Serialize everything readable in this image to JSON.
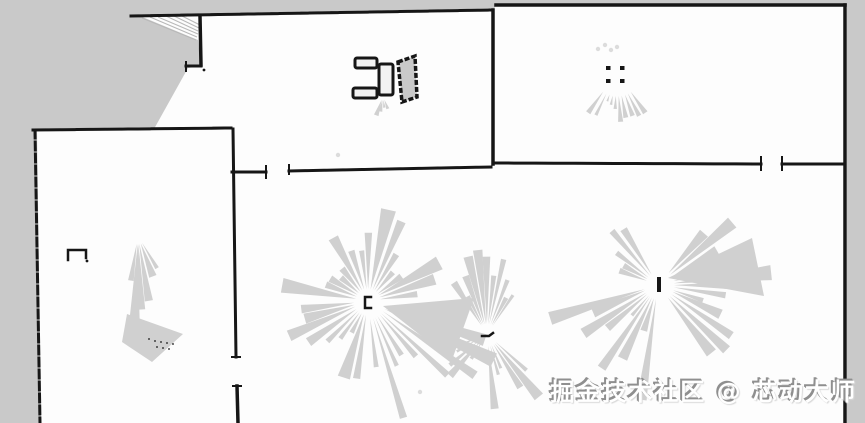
{
  "meta": {
    "width": 865,
    "height": 423,
    "description": "Lidar SLAM occupancy-grid floor map: white explored space, gray unknown space, black walls and obstacles, gray laser-scan shadow fans"
  },
  "watermark": {
    "text": "掘金技术社区 @ 芯动大师"
  },
  "colors": {
    "free": "#fdfdfd",
    "unknown": "#c9c9c9",
    "wall": "#161616",
    "scan": "#d0d0d0",
    "scan_light": "#dcdcdc",
    "hatch": "#b8b8b8"
  },
  "map": {
    "unknown_regions": [
      {
        "name": "unknown-top-band",
        "pts": [
          [
            0,
            0
          ],
          [
            865,
            0
          ],
          [
            865,
            5
          ],
          [
            496,
            5
          ],
          [
            493,
            11
          ],
          [
            131,
            16
          ],
          [
            0,
            16
          ]
        ]
      },
      {
        "name": "unknown-left-block",
        "pts": [
          [
            0,
            16
          ],
          [
            140,
            16
          ],
          [
            198,
            40
          ],
          [
            201,
            66
          ],
          [
            188,
            68
          ],
          [
            154,
            129
          ],
          [
            37,
            130
          ],
          [
            41,
            423
          ],
          [
            0,
            423
          ]
        ]
      },
      {
        "name": "unknown-right-margin",
        "pts": [
          [
            847,
            5
          ],
          [
            865,
            5
          ],
          [
            865,
            423
          ],
          [
            847,
            423
          ]
        ]
      }
    ],
    "hatch_lines": [
      {
        "pts": [
          [
            142,
            18
          ],
          [
            196,
            40
          ]
        ]
      },
      {
        "pts": [
          [
            150,
            17
          ],
          [
            197,
            37
          ]
        ]
      },
      {
        "pts": [
          [
            158,
            17
          ],
          [
            198,
            34
          ]
        ]
      },
      {
        "pts": [
          [
            166,
            16
          ],
          [
            198,
            31
          ]
        ]
      },
      {
        "pts": [
          [
            174,
            16
          ],
          [
            199,
            28
          ]
        ]
      },
      {
        "pts": [
          [
            182,
            16
          ],
          [
            200,
            25
          ]
        ]
      }
    ],
    "walls": [
      {
        "name": "hall-top-wall",
        "pts": [
          [
            131,
            16
          ],
          [
            493,
            10
          ]
        ],
        "w": 3,
        "dash": "7,3"
      },
      {
        "name": "center-divider-wall",
        "pts": [
          [
            493,
            10
          ],
          [
            493,
            164
          ]
        ],
        "w": 3.5
      },
      {
        "name": "top-right-room-top-wall",
        "pts": [
          [
            496,
            5
          ],
          [
            845,
            5
          ]
        ],
        "w": 3.5,
        "dash": "16,2"
      },
      {
        "name": "right-outer-wall",
        "pts": [
          [
            845,
            5
          ],
          [
            845,
            423
          ]
        ],
        "w": 3.5
      },
      {
        "name": "top-right-room-bottom-wall-left",
        "pts": [
          [
            496,
            163
          ],
          [
            761,
            164
          ]
        ],
        "w": 3,
        "dash": "18,2"
      },
      {
        "name": "door-tick-right-room-a",
        "pts": [
          [
            761,
            157
          ],
          [
            761,
            170
          ]
        ],
        "w": 2
      },
      {
        "name": "top-right-room-bottom-wall-right",
        "pts": [
          [
            782,
            164
          ],
          [
            845,
            164
          ]
        ],
        "w": 3
      },
      {
        "name": "door-tick-right-room-b",
        "pts": [
          [
            782,
            157
          ],
          [
            782,
            170
          ]
        ],
        "w": 2
      },
      {
        "name": "corridor-wall-long",
        "pts": [
          [
            289,
            171
          ],
          [
            491,
            167
          ]
        ],
        "w": 3,
        "dash": "16,3"
      },
      {
        "name": "door-tick-corridor-a",
        "pts": [
          [
            289,
            165
          ],
          [
            289,
            174
          ]
        ],
        "w": 2
      },
      {
        "name": "corridor-wall-short",
        "pts": [
          [
            232,
            172
          ],
          [
            266,
            172
          ]
        ],
        "w": 3
      },
      {
        "name": "door-tick-corridor-b",
        "pts": [
          [
            266,
            166
          ],
          [
            266,
            178
          ]
        ],
        "w": 2
      },
      {
        "name": "left-room-top-wall",
        "pts": [
          [
            33,
            130
          ],
          [
            231,
            128
          ]
        ],
        "w": 3,
        "dash": "12,3"
      },
      {
        "name": "left-room-left-wall",
        "pts": [
          [
            35,
            130
          ],
          [
            40,
            423
          ]
        ],
        "w": 3,
        "dash": "8,4"
      },
      {
        "name": "left-divider-wall-upper",
        "pts": [
          [
            233,
            129
          ],
          [
            236,
            357
          ]
        ],
        "w": 3
      },
      {
        "name": "left-divider-wall-lower",
        "pts": [
          [
            237,
            386
          ],
          [
            238,
            423
          ]
        ],
        "w": 3.5
      },
      {
        "name": "door-tick-left-divider-a",
        "pts": [
          [
            232,
            357
          ],
          [
            240,
            357
          ]
        ],
        "w": 2
      },
      {
        "name": "door-tick-left-divider-b",
        "pts": [
          [
            233,
            386
          ],
          [
            241,
            386
          ]
        ],
        "w": 2
      },
      {
        "name": "hall-left-wall",
        "pts": [
          [
            200,
            16
          ],
          [
            201,
            65
          ]
        ],
        "w": 3.5
      },
      {
        "name": "hall-nub-wall",
        "pts": [
          [
            186,
            66
          ],
          [
            201,
            66
          ]
        ],
        "w": 3
      },
      {
        "name": "hall-nub-tick",
        "pts": [
          [
            186,
            62
          ],
          [
            186,
            71
          ]
        ],
        "w": 2
      }
    ],
    "obstacle_rects": [
      {
        "name": "obstacle-box-1",
        "x": 355,
        "y": 58,
        "w": 22,
        "h": 10
      },
      {
        "name": "obstacle-box-2",
        "x": 379,
        "y": 64,
        "w": 14,
        "h": 31
      },
      {
        "name": "obstacle-box-3",
        "x": 353,
        "y": 88,
        "w": 24,
        "h": 10
      }
    ],
    "obstacle_quad": {
      "name": "obstacle-tilted-panel",
      "pts": [
        [
          398,
          62
        ],
        [
          415,
          56
        ],
        [
          417,
          97
        ],
        [
          402,
          102
        ]
      ]
    },
    "table_legs": [
      {
        "x": 606,
        "y": 66
      },
      {
        "x": 620,
        "y": 66
      },
      {
        "x": 606,
        "y": 79
      },
      {
        "x": 620,
        "y": 79
      }
    ],
    "markers": [
      {
        "name": "marker-left-room",
        "d": "M68,260 L68,250 L86,250 L86,258",
        "w": 2.5
      },
      {
        "name": "robot-pose-marker-a",
        "d": "M371,297 L365,297 L365,308 L371,308",
        "w": 2.5
      },
      {
        "name": "scan-dash-marker",
        "d": "M482,336 l7,0 l4,-3",
        "w": 2.5
      }
    ],
    "marker_rects": [
      {
        "name": "robot-pose-marker-b",
        "x": 657,
        "y": 277,
        "w": 4,
        "h": 15
      }
    ],
    "marker_dots": [
      {
        "x": 87,
        "y": 261
      },
      {
        "x": 204,
        "y": 70
      }
    ],
    "hatch_dots": [
      [
        149,
        339
      ],
      [
        155,
        341
      ],
      [
        161,
        342
      ],
      [
        167,
        343
      ],
      [
        173,
        344
      ],
      [
        157,
        347
      ],
      [
        163,
        348
      ],
      [
        169,
        349
      ]
    ],
    "light_specks": [
      [
        598,
        49
      ],
      [
        605,
        45
      ],
      [
        611,
        50
      ],
      [
        617,
        47
      ],
      [
        338,
        155
      ],
      [
        420,
        392
      ]
    ],
    "scan_solids": [
      {
        "name": "scan-shadow-wedge-a",
        "pts": [
          [
            383,
            306
          ],
          [
            474,
            298
          ],
          [
            452,
            360
          ]
        ]
      },
      {
        "name": "scan-shadow-triangle-left-room",
        "pts": [
          [
            127,
            314
          ],
          [
            183,
            334
          ],
          [
            152,
            362
          ],
          [
            122,
            342
          ]
        ]
      },
      {
        "name": "scan-shadow-wedge-c",
        "pts": [
          [
            668,
            278
          ],
          [
            752,
            238
          ],
          [
            764,
            296
          ]
        ]
      }
    ],
    "scan_fans": [
      {
        "name": "scan-fan-a",
        "cx": 368,
        "cy": 301,
        "sectors": [
          {
            "a0": 185,
            "a1": 358,
            "n": 17,
            "r0": 35,
            "r1": 95,
            "inner": 12,
            "wf": 0.4
          },
          {
            "a0": 95,
            "a1": 178,
            "n": 9,
            "r0": 30,
            "r1": 88,
            "inner": 14,
            "wf": 0.38
          },
          {
            "a0": 14,
            "a1": 86,
            "n": 9,
            "r0": 45,
            "r1": 140,
            "inner": 18,
            "wf": 0.3
          }
        ]
      },
      {
        "name": "scan-fan-b",
        "cx": 487,
        "cy": 334,
        "sectors": [
          {
            "a0": 233,
            "a1": 307,
            "n": 11,
            "r0": 40,
            "r1": 103,
            "inner": 10,
            "wf": 0.42
          },
          {
            "a0": 38,
            "a1": 88,
            "n": 6,
            "r0": 30,
            "r1": 85,
            "inner": 12,
            "wf": 0.35
          },
          {
            "a0": 118,
            "a1": 162,
            "n": 5,
            "r0": 25,
            "r1": 65,
            "inner": 10,
            "wf": 0.35
          }
        ]
      },
      {
        "name": "scan-fan-c",
        "cx": 658,
        "cy": 285,
        "sectors": [
          {
            "a0": -52,
            "a1": 55,
            "n": 13,
            "r0": 45,
            "r1": 115,
            "inner": 16,
            "wf": 0.45
          },
          {
            "a0": 95,
            "a1": 168,
            "n": 9,
            "r0": 35,
            "r1": 118,
            "inner": 14,
            "wf": 0.4
          },
          {
            "a0": 196,
            "a1": 242,
            "n": 5,
            "r0": 28,
            "r1": 72,
            "inner": 12,
            "wf": 0.38
          }
        ]
      },
      {
        "name": "scan-shadow-row-right-room",
        "cx": 617,
        "cy": 72,
        "sectors": [
          {
            "a0": 52,
            "a1": 128,
            "n": 10,
            "r0": 30,
            "r1": 52,
            "inner": 24,
            "wf": 0.34
          }
        ]
      },
      {
        "name": "scan-chain-left-room",
        "cx": 138,
        "cy": 236,
        "sectors": [
          {
            "a0": 78,
            "a1": 102,
            "n": 4,
            "r0": 40,
            "r1": 100,
            "inner": 8,
            "wf": 0.5
          },
          {
            "a0": 55,
            "a1": 75,
            "n": 2,
            "r0": 20,
            "r1": 45,
            "inner": 8,
            "wf": 0.4
          }
        ]
      },
      {
        "name": "scan-smudge-hall",
        "cx": 383,
        "cy": 96,
        "sectors": [
          {
            "a0": 62,
            "a1": 118,
            "n": 4,
            "r0": 10,
            "r1": 30,
            "inner": 4,
            "wf": 0.4
          }
        ]
      }
    ]
  }
}
